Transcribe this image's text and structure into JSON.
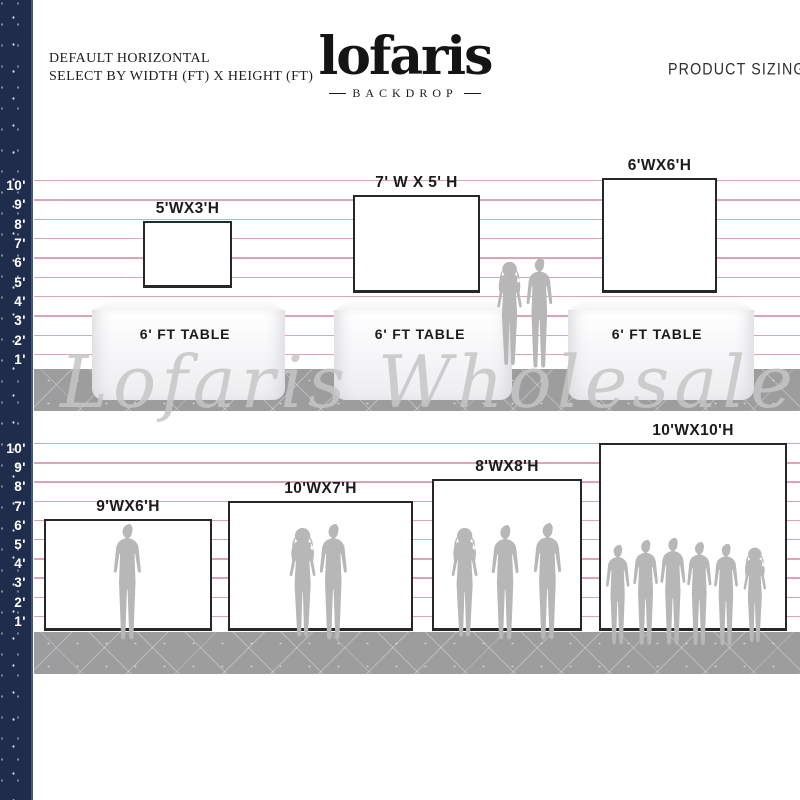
{
  "header": {
    "subtitle_line1": "DEFAULT HORIZONTAL",
    "subtitle_line2": "SELECT BY WIDTH (FT) X HEIGHT (FT)",
    "logo_text": "lofaris",
    "logo_subtext": "BACKDROP",
    "product_sizing": "PRODUCT SIZING"
  },
  "watermark": "Lofaris Wholesale",
  "ruler_labels": [
    "10'",
    "9'",
    "8'",
    "7'",
    "6'",
    "5'",
    "4'",
    "3'",
    "2'",
    "1'"
  ],
  "sections": [
    {
      "name": "top",
      "backdrops": [
        {
          "label": "5'WX3'H",
          "width_ft": 5,
          "height_ft": 3
        },
        {
          "label": "7' W X 5' H",
          "width_ft": 7,
          "height_ft": 5
        },
        {
          "label": "6'WX6'H",
          "width_ft": 6,
          "height_ft": 6
        }
      ],
      "tables": [
        {
          "label": "6' FT TABLE"
        },
        {
          "label": "6' FT TABLE"
        },
        {
          "label": "6' FT TABLE"
        }
      ]
    },
    {
      "name": "bottom",
      "backdrops": [
        {
          "label": "9'WX6'H",
          "width_ft": 9,
          "height_ft": 6
        },
        {
          "label": "10'WX7'H",
          "width_ft": 10,
          "height_ft": 7
        },
        {
          "label": "8'WX8'H",
          "width_ft": 8,
          "height_ft": 8
        },
        {
          "label": "10'WX10'H",
          "width_ft": 10,
          "height_ft": 10
        }
      ]
    }
  ],
  "colors": {
    "navy": "#1f2c4c",
    "pink_line": "#dca4b4",
    "floor_gray": "#9d9d9d",
    "silhouette_gray": "#b7b7b7",
    "text_dark": "#1b1b1b"
  }
}
